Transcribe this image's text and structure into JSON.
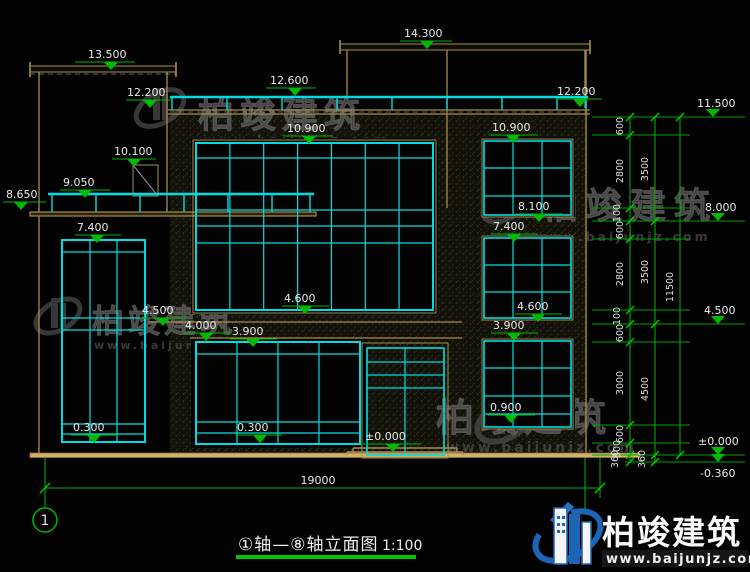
{
  "title": {
    "text": "①轴—⑧轴立面图",
    "scale": "1:100"
  },
  "axis": {
    "label_1": "1"
  },
  "dims": {
    "overall_width": "19000"
  },
  "elevations": {
    "v13500": "13.500",
    "v14300": "14.300",
    "v12600": "12.600",
    "v12200_left": "12.200",
    "v12200_right": "12.200",
    "v11500": "11.500",
    "v10900_center": "10.900",
    "v10900_right": "10.900",
    "v10100": "10.100",
    "v9050": "9.050",
    "v8650": "8.650",
    "v8100": "8.100",
    "v8000": "8.000",
    "v7400_left": "7.400",
    "v7400_right": "7.400",
    "v4600_center": "4.600",
    "v4600_right": "4.600",
    "v4500_left": "4.500",
    "v4500_right": "4.500",
    "v4000": "4.000",
    "v3900_center": "3.900",
    "v3900_right": "3.900",
    "v0900": "0.900",
    "v0300_left": "0.300",
    "v0300_center": "0.300",
    "v0000_door": "±0.000",
    "v0000_right": "±0.000",
    "vm0360": "-0.360"
  },
  "dim_chains": {
    "col1": [
      "600",
      "2800",
      "100",
      "600",
      "2800",
      "100",
      "600",
      "3000",
      "600",
      "300",
      "360"
    ],
    "col2": [
      "3500",
      "3500",
      "4500",
      "360"
    ],
    "col3": [
      "11500"
    ]
  },
  "watermark": {
    "cn": "柏竣建筑",
    "url": "www.baijunjz.com"
  },
  "logo": {
    "cn": "柏竣建筑",
    "url": "www.baijunjz.com"
  }
}
